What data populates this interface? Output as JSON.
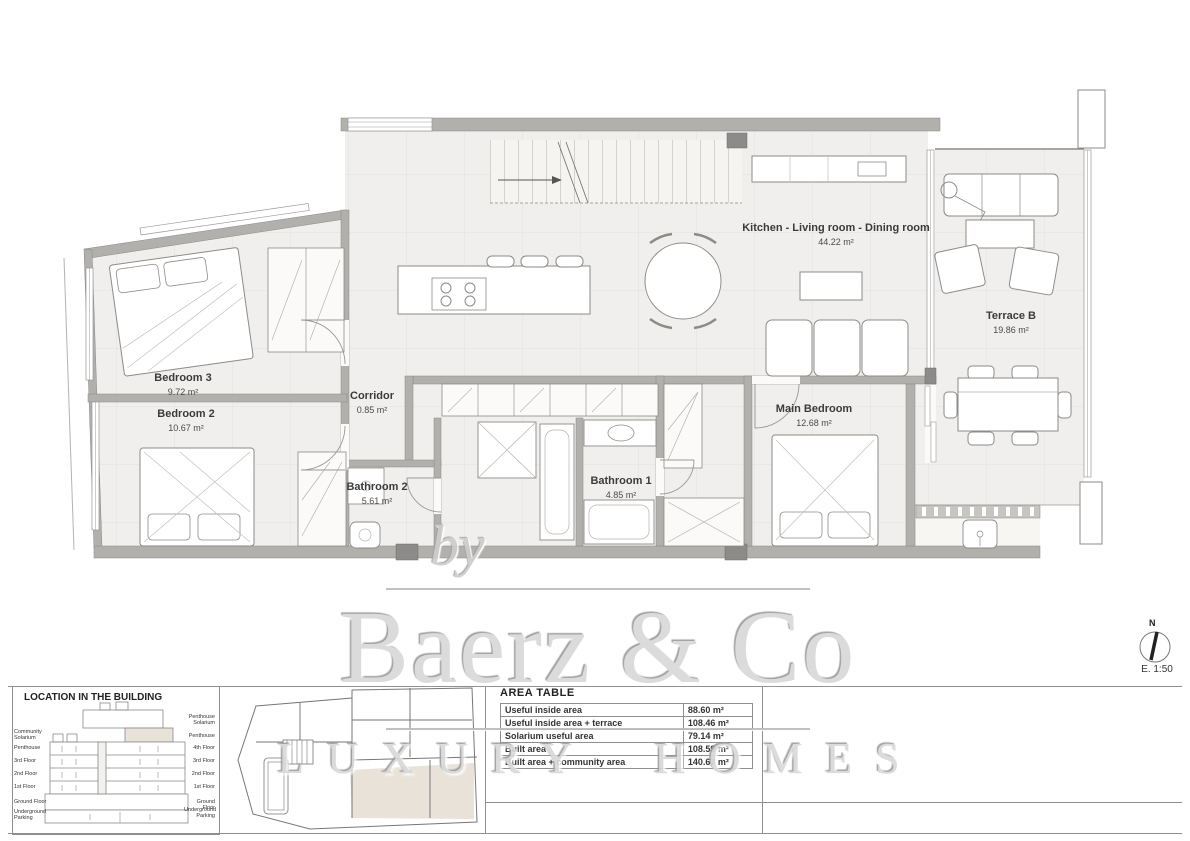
{
  "plan": {
    "rooms": [
      {
        "name": "Bedroom 3",
        "area": "9.72 m²"
      },
      {
        "name": "Bedroom 2",
        "area": "10.67 m²"
      },
      {
        "name": "Corridor",
        "area": "0.85 m²"
      },
      {
        "name": "Bathroom 2",
        "area": "5.61 m²"
      },
      {
        "name": "Bathroom 1",
        "area": "4.85 m²"
      },
      {
        "name": "Main Bedroom",
        "area": "12.68 m²"
      },
      {
        "name": "Kitchen - Living room - Dining room",
        "area": "44.22 m²"
      },
      {
        "name": "Terrace B",
        "area": "19.86 m²"
      }
    ]
  },
  "area_table": {
    "title": "AREA TABLE",
    "rows": [
      {
        "label": "Useful inside area",
        "value": "88.60 m²"
      },
      {
        "label": "Useful inside area + terrace",
        "value": "108.46 m²"
      },
      {
        "label": "Solarium useful area",
        "value": "79.14 m²"
      },
      {
        "label": "Built area",
        "value": "108.59 m²"
      },
      {
        "label": "Built area + community area",
        "value": "140.67 m²"
      }
    ]
  },
  "location": {
    "title": "LOCATION IN THE BUILDING",
    "left_labels": [
      "Community Solarium",
      "Penthouse",
      "3rd Floor",
      "2nd Floor",
      "1st Floor",
      "Ground Floor",
      "Underground Parking"
    ],
    "right_labels": [
      "Penthouse Solarium",
      "Penthouse",
      "4th Floor",
      "3rd Floor",
      "2nd Floor",
      "1st Floor",
      "Ground Floor",
      "Underground Parking"
    ]
  },
  "watermark": {
    "by": "by",
    "brand": "Baerz & Co",
    "tagline": "LUXURY HOMES"
  },
  "compass": {
    "north": "N",
    "scale": "E. 1:50"
  },
  "colors": {
    "highlight": "#e9e2d9",
    "wall": "#b2b0ad",
    "floor": "#f0efed"
  }
}
